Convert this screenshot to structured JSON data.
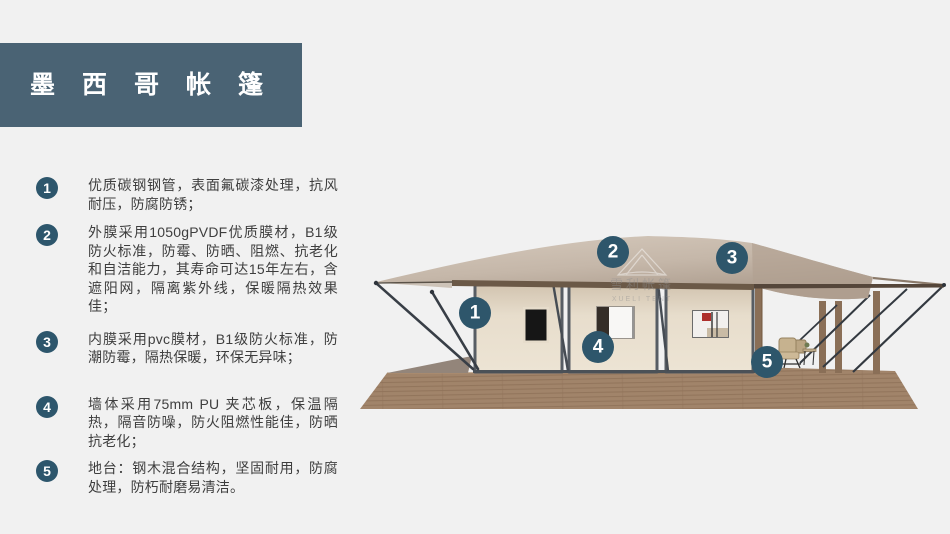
{
  "palette": {
    "background": "#f1f1f1",
    "title_bar": "#4a6374",
    "badge_circle": "#2d566c",
    "canopy_tan_light": "#d3c7ba",
    "canopy_tan_dark": "#b1a091",
    "wall_cream": "#e9dfce",
    "frame_gray": "#575d64",
    "deck_wood": "#a1846a",
    "brace_steel": "#383e46",
    "text_dark": "#3e3e3e"
  },
  "header": {
    "title": "墨西哥帐篷"
  },
  "features": [
    {
      "num": "1",
      "text": "优质碳钢钢管，表面氟碳漆处理，抗风耐压，防腐防锈；"
    },
    {
      "num": "2",
      "text": "外膜采用1050gPVDF优质膜材，B1级防火标准，防霉、防晒、阻燃、抗老化和自洁能力，其寿命可达15年左右，含遮阳网，隔离紫外线，保暖隔热效果佳；"
    },
    {
      "num": "3",
      "text": "内膜采用pvc膜材，B1级防火标准，防潮防霉，隔热保暖，环保无异味；"
    },
    {
      "num": "4",
      "text": "墙体采用75mm PU 夹芯板，保温隔热，隔音防噪，防火阻燃性能佳，防晒抗老化；"
    },
    {
      "num": "5",
      "text": "地台：钢木混合结构，坚固耐用，防腐处理，防朽耐磨易清洁。"
    }
  ],
  "figure": {
    "callouts": [
      "1",
      "2",
      "3",
      "4",
      "5"
    ],
    "watermark": {
      "cn": "雪利帐篷",
      "en": "XUELI TENT"
    }
  }
}
